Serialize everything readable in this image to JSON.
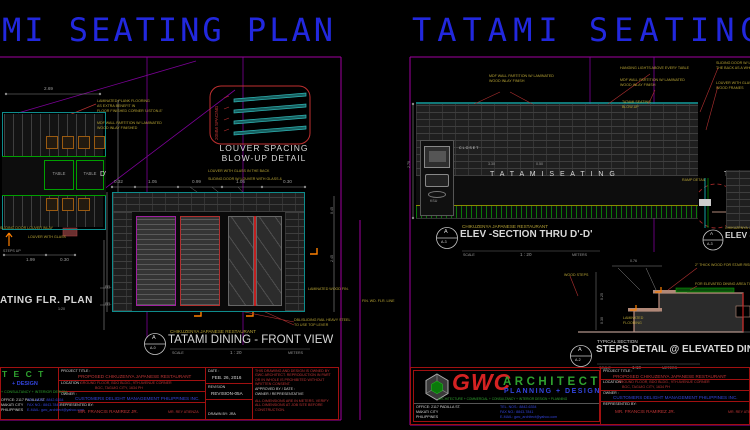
{
  "colors": {
    "title_blue": "#2228de",
    "border_magenta": "#b000b0",
    "cad_cyan": "#15a0a0",
    "annotation_yellow": "#b8a435",
    "cad_red": "#c03535",
    "cad_green": "#2fa22f",
    "arrow_orange": "#ff8000",
    "logo_red": "#d42222",
    "logo_blue": "#3344dd"
  },
  "titles": {
    "left": "MI SEATING PLAN",
    "right": "TATAMI SEATING"
  },
  "left": {
    "plan": {
      "dim_top": "2.69",
      "dim_b1": "1.99",
      "dim_b2": "0.30",
      "tables": [
        "TABLE",
        "TABLE"
      ],
      "ann_floor": [
        "LAMINATED PLANK FLOORING",
        "AS EXTRA BENEFIT IN",
        "FLOOR FINISHED CORNER 'LISTON-E'"
      ],
      "ann_wall": [
        "MDF WALL PARTITION W/ LAMINATED",
        "WOOD INLAY FINISHED"
      ],
      "ann_door": "SLIDING DOOR LOUVER INLAY",
      "ann_louver": "LOUVER WITH GLASS",
      "steps_up": "STEPS UP",
      "ffl1": "FFL",
      "ffl2": "FFL",
      "marker": "D'",
      "title": "ATING FLR. PLAN",
      "scale": "1:20"
    },
    "louver": {
      "spacing": "20MM SPACING",
      "title1": "LOUVER SPACING",
      "title2": "BLOW-UP DETAIL",
      "note1": "LOUVER WITH GLASS IN THE BACK",
      "note2": "SLIDING DOOR W/ LOUVER WITH GLASS &"
    },
    "front": {
      "dims": [
        "0.32",
        "1.05",
        "0.99",
        "1.05",
        "0.30"
      ],
      "vdim1": "2.45",
      "vdim2": "0.45",
      "subtitle": "CHIKUZENYA JAPANESE RESTAURANT",
      "title": "TATAMI DINING - FRONT VIEW",
      "marker_a": "A",
      "marker_b": "A-0",
      "scale_lbl": "SCALE",
      "scale_val": "1 : 20",
      "scale_unit": "METERS",
      "ann_rail": [
        "DBL/SLIDING RAIL HEAVY STEEL",
        "TO USE TOP LEVER"
      ],
      "ann_lam": "LAMINATED WOOD FIN.",
      "ann_fin": "FIN. WD. FLR. LINE"
    },
    "tbl": {
      "logo_tail1": "T E C T",
      "logo_tail2": "+ DESIGN",
      "logo_tail3": "+ CONSULTANCY + INTERIOR DESIGN"
    }
  },
  "right": {
    "elev": {
      "ann_wall1": [
        "MDF WALL PARTITION W/ LAMINATED",
        "WOOD INLAY FINISH"
      ],
      "ann_lights": "HANGING LIGHTS ABOVE EVERY TABLE",
      "ann_wall2": [
        "MDF WALL PARTITION W/ LAMINATED",
        "WOOD INLAY FINISH"
      ],
      "ann_slide": [
        "SLIDING DOOR W/ LOUVER IN",
        "THE BACK AS A WHOLE"
      ],
      "ann_glass": [
        "LOUVER WITH GLASS &",
        "WOOD FRAMES"
      ],
      "ann_blowup": [
        "TATAMI SEATING",
        "BLOW-UP"
      ],
      "closet": "CLOSET",
      "ksu": "KSU",
      "seating": "T A T A M I   S E A T I N G",
      "seating2": "T A T A M I",
      "dim0": "2.70",
      "dim1": "3.30",
      "dim2": "0.50",
      "subtitle": "CHIKUZENYA JAPANESE RESTAURANT",
      "title": "ELEV -SECTION THRU  D'-D'",
      "marker_a": "A",
      "marker_b": "A-3",
      "scale_lbl": "SCALE",
      "scale_val": "1 : 20",
      "scale_unit": "METERS"
    },
    "corner": {
      "ann": "RAMP DETAIL",
      "subtitle": "CHIKUZENYA JA",
      "title": "ELEV -SECTION",
      "marker_a": "A",
      "marker_b": "A-3"
    },
    "steps": {
      "subtitle": "TYPICAL SECTION",
      "title": "STEPS DETAIL @ ELEVATED DINING AR",
      "marker_a": "A",
      "marker_b": "A-2",
      "scale_lbl": "SCALE",
      "scale_val": "1:10",
      "scale_unit": "METERS",
      "ann_riser": "WOOD STEPS",
      "ann_wood": "2\" THICK WOOD FOR STAIR RISE & TREAD",
      "ann_top": "FOR ELEVATED DINING AREA TOP",
      "ann_lam": [
        "LAMINATED",
        "FLOORING"
      ],
      "dim1": "0.76",
      "dim2": "0.25",
      "dim3": "0.30"
    }
  },
  "tb": {
    "project_label": "PROJECT TITLE :",
    "project": "PROPOSED CHIKUZENYA  JAPANESE RESTAURANT",
    "location_label": "LOCATION :",
    "location1": "GROUND FLOOR, BDO BLDG., 9TH AVENUE CORNER",
    "location2": "BGC, TAGUIG CITY, 1634 PH",
    "owner_label": "OWNER :",
    "owner": "CUSTOMERS DELIGHT MANAGEMENT PHILIPPINES INC.",
    "rep_label": "REPRESENTED BY:",
    "rep": "MR. FRANCIS RAMIREZ JR.",
    "rep2": "MR. REY ATIENZA",
    "date_label": "DATE :",
    "date": "FEB. 26, 2016",
    "rev_label": "REVISION",
    "rev": "REVISION-05A",
    "drawn": "DRAWN BY: JRA",
    "notes1": "THIS DRAWING AND DESIGN IS OWNED BY GWC ARCHITECT. REPRODUCTION IN PART OR IN WHOLE IS PROHIBITED WITHOUT WRITTEN CONSENT.",
    "approval1": "APPROVED BY / DATE :",
    "approval2": "OWNER / REPRESENTATIVE",
    "notes2": "ALL DIMENSIONS ARE IN METERS. VERIFY ALL DIMENSIONS AT JOB SITE BEFORE CONSTRUCTION.",
    "logo": {
      "gwc": "GWC",
      "architect": "ARCHITECT",
      "tagline": "PLANNING + DESIGN",
      "services": "ARCHITECTURE  +  COMMERCIAL  +  CONSULTANCY  +  INTERIOR DESIGN  +  PLANNING"
    },
    "addr": [
      "OFFICE: 2117 PADILLA ST.",
      "MAKATI CITY",
      "PHILIPPINES"
    ],
    "contact": [
      "TEL. NOS.: 8842-6354",
      "FAX NO.: 8843-7841",
      "E-MAIL: gwc_architect@yahoo.com"
    ]
  }
}
